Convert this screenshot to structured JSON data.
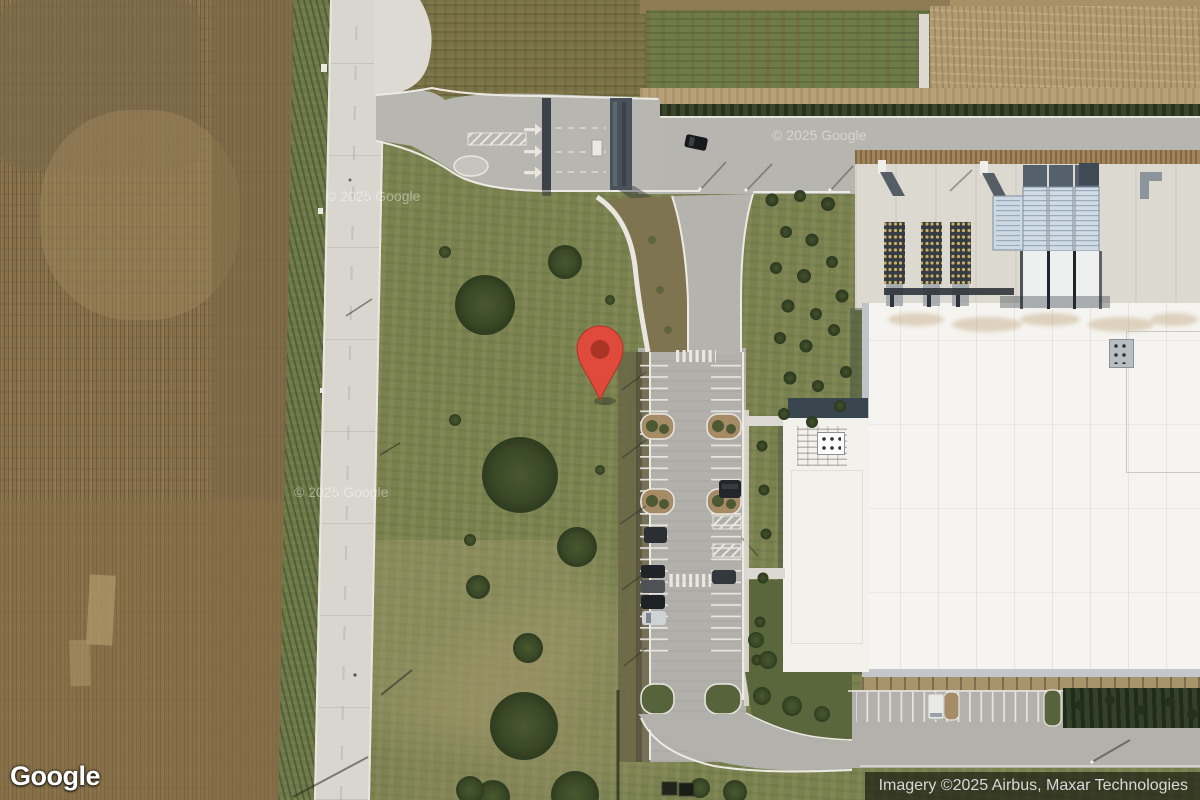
{
  "map": {
    "view": "satellite",
    "logo_text": "Google",
    "attribution_text": "Imagery ©2025 Airbus, Maxar Technologies",
    "watermark_text": "© 2025 Google",
    "marker": {
      "pixel_x": 600,
      "pixel_y": 400,
      "color": "#E04A3B",
      "inner_color": "#A93527"
    }
  },
  "colors": {
    "pin_red": "#E04A3B",
    "pin_inner": "#A93527",
    "attribution_bg": "rgba(0,0,0,0.55)",
    "attribution_fg": "#D8D8D8",
    "road": "#D8D6CE",
    "asphalt": "#B5B3AE",
    "farmland": "#85704B",
    "lawn": "#79814F",
    "roof_white": "#F5F4F0",
    "hedge_green": "#3A462C"
  }
}
